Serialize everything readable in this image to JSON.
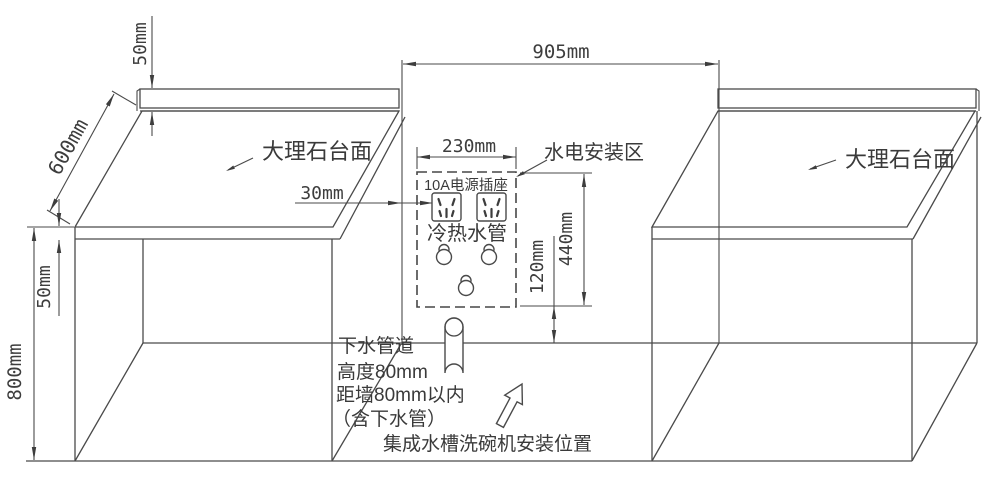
{
  "dims": {
    "d905": "905mm",
    "d230": "230mm",
    "d30": "30mm",
    "d50_top": "50mm",
    "d50_slab": "50mm",
    "d600": "600mm",
    "d800": "800mm",
    "d440": "440mm",
    "d120": "120mm"
  },
  "labels": {
    "countertop_left": "大理石台面",
    "countertop_right": "大理石台面",
    "utility_zone": "水电安装区",
    "outlet": "10A电源插座",
    "pipes": "冷热水管",
    "drain_1": "下水管道",
    "drain_2": "高度80mm",
    "drain_3": "距墙80mm以内",
    "drain_4": "（含下水管）",
    "position": "集成水槽洗碗机安装位置"
  },
  "colors": {
    "line": "#4a4a4a",
    "text": "#3d3d3d",
    "background": "#ffffff"
  }
}
